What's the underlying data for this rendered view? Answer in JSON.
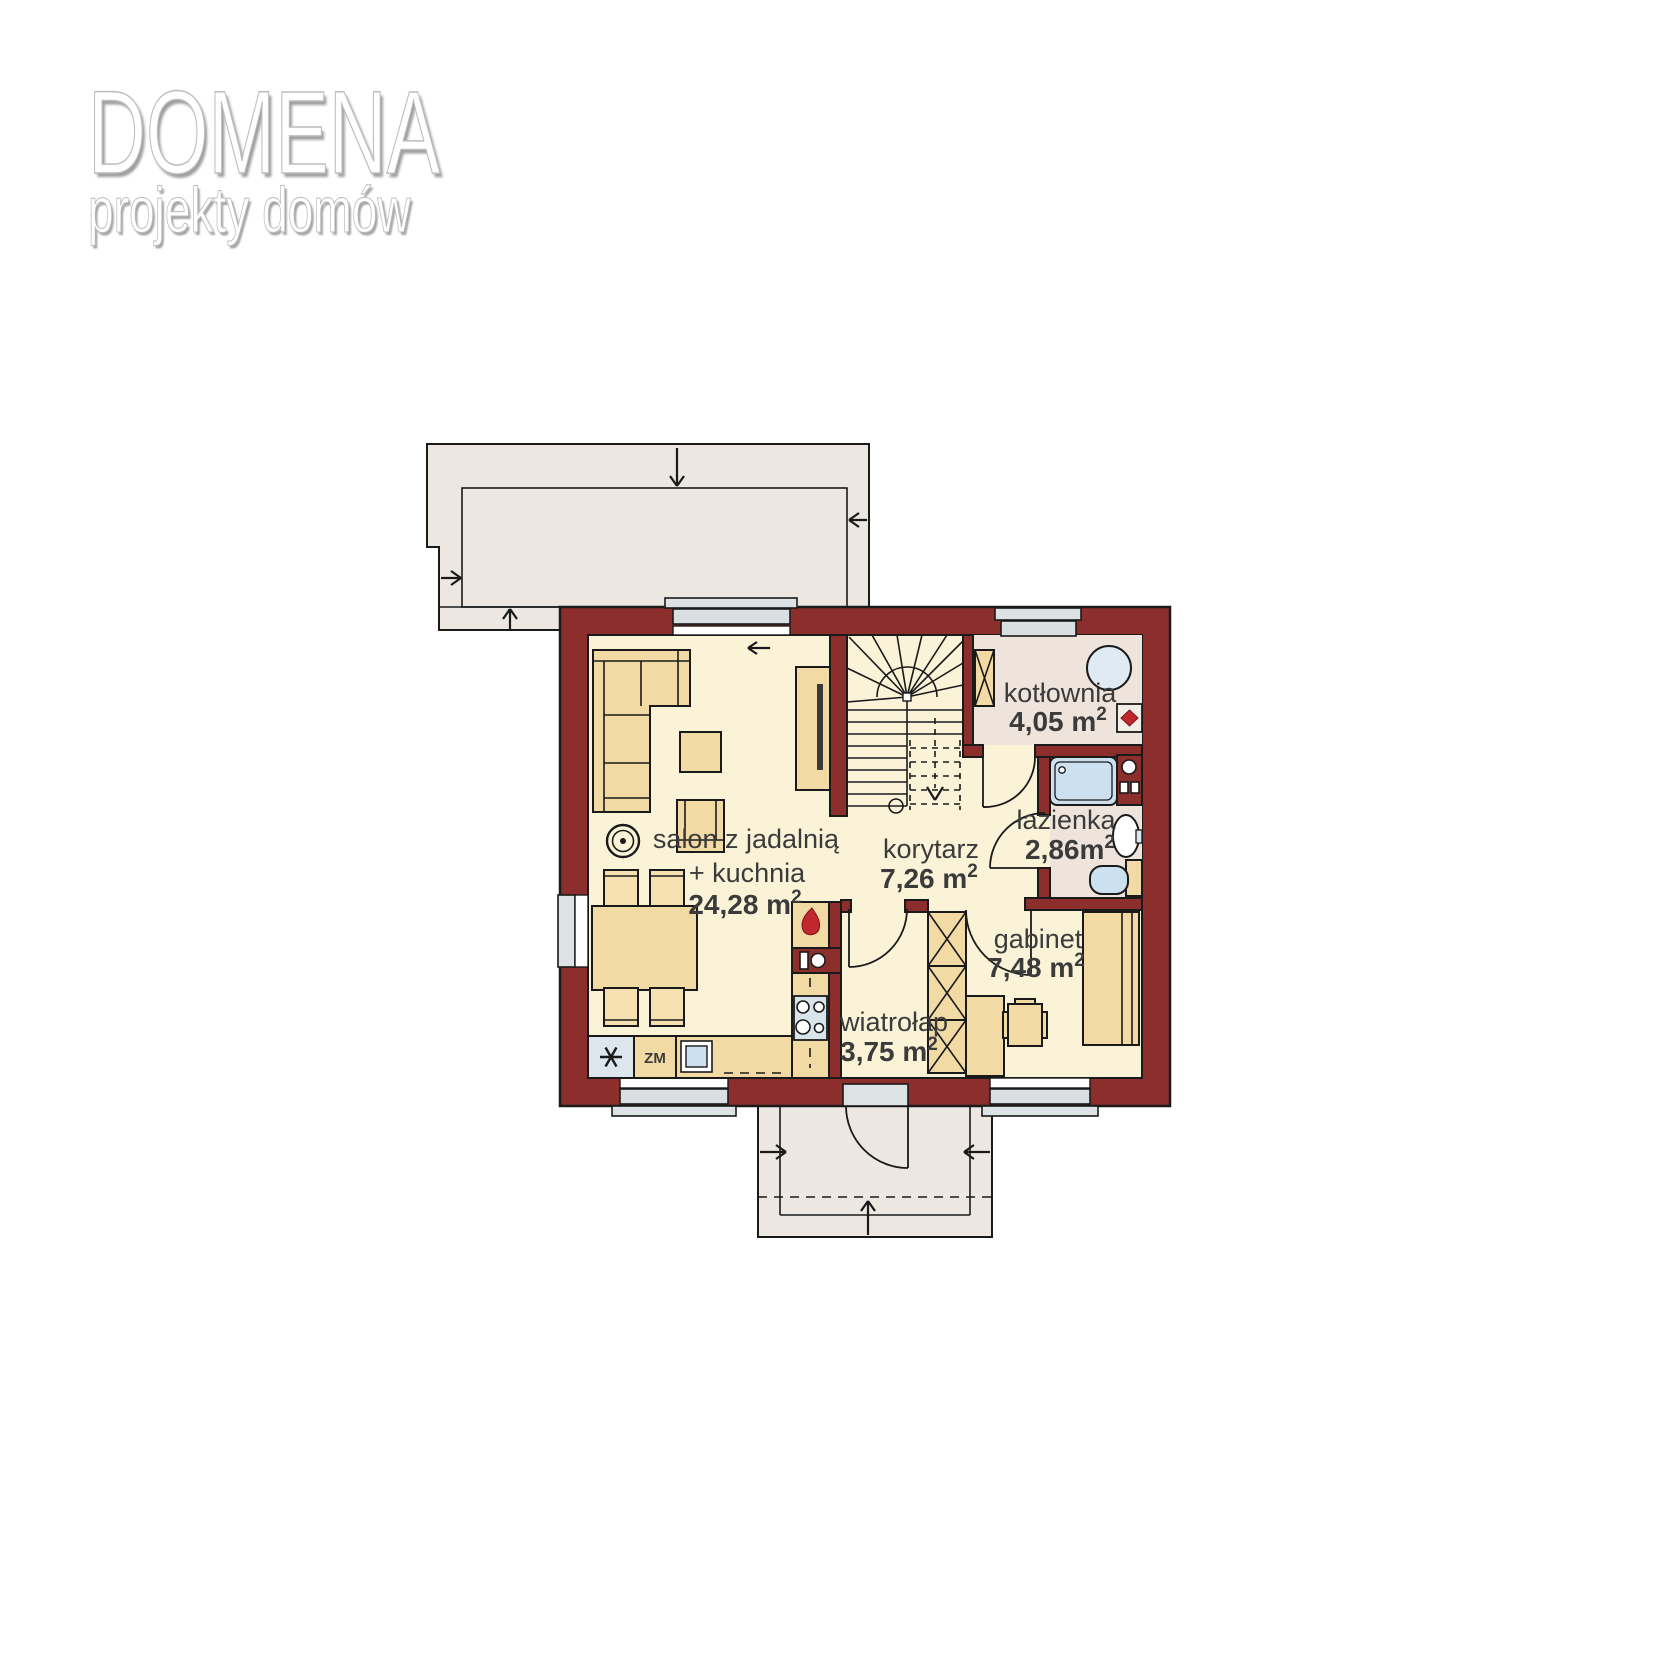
{
  "logo": {
    "title": "DOMENA",
    "subtitle": "projekty domów"
  },
  "plan": {
    "rooms": [
      {
        "id": "salon",
        "name_lines": [
          "salon z jadalnią",
          "+ kuchnia"
        ],
        "area": "24,28 m",
        "area_sup": "2"
      },
      {
        "id": "korytarz",
        "name_lines": [
          "korytarz"
        ],
        "area": "7,26 m",
        "area_sup": "2"
      },
      {
        "id": "kotlownia",
        "name_lines": [
          "kotłownia"
        ],
        "area": "4,05 m",
        "area_sup": "2"
      },
      {
        "id": "lazienka",
        "name_lines": [
          "łazienka"
        ],
        "area": "2,86m",
        "area_sup": "2"
      },
      {
        "id": "gabinet",
        "name_lines": [
          "gabinet"
        ],
        "area": "7,48 m",
        "area_sup": "2"
      },
      {
        "id": "wiatrolap",
        "name_lines": [
          "wiatrołap"
        ],
        "area": "3,75 m",
        "area_sup": "2"
      }
    ],
    "annotations": {
      "dishwasher_label": "ZM"
    },
    "icons": {
      "freezer": "snowflake-star-icon",
      "kitchen_flue": "flame-icon",
      "boiler_vent": "red-diamond-icon",
      "speaker": "speaker-circle-icon"
    },
    "colors": {
      "wall": "#8C2E2B",
      "floor_main": "#FAF3D8",
      "floor_utility": "#EFE4DC",
      "terrace": "#ECE8E1",
      "furniture": "#F2DAA4",
      "window": "#D8DEE1",
      "fixture_blue": "#CCE0EF",
      "accent_red": "#C1272D",
      "label_text": "#3B3B3B"
    }
  }
}
